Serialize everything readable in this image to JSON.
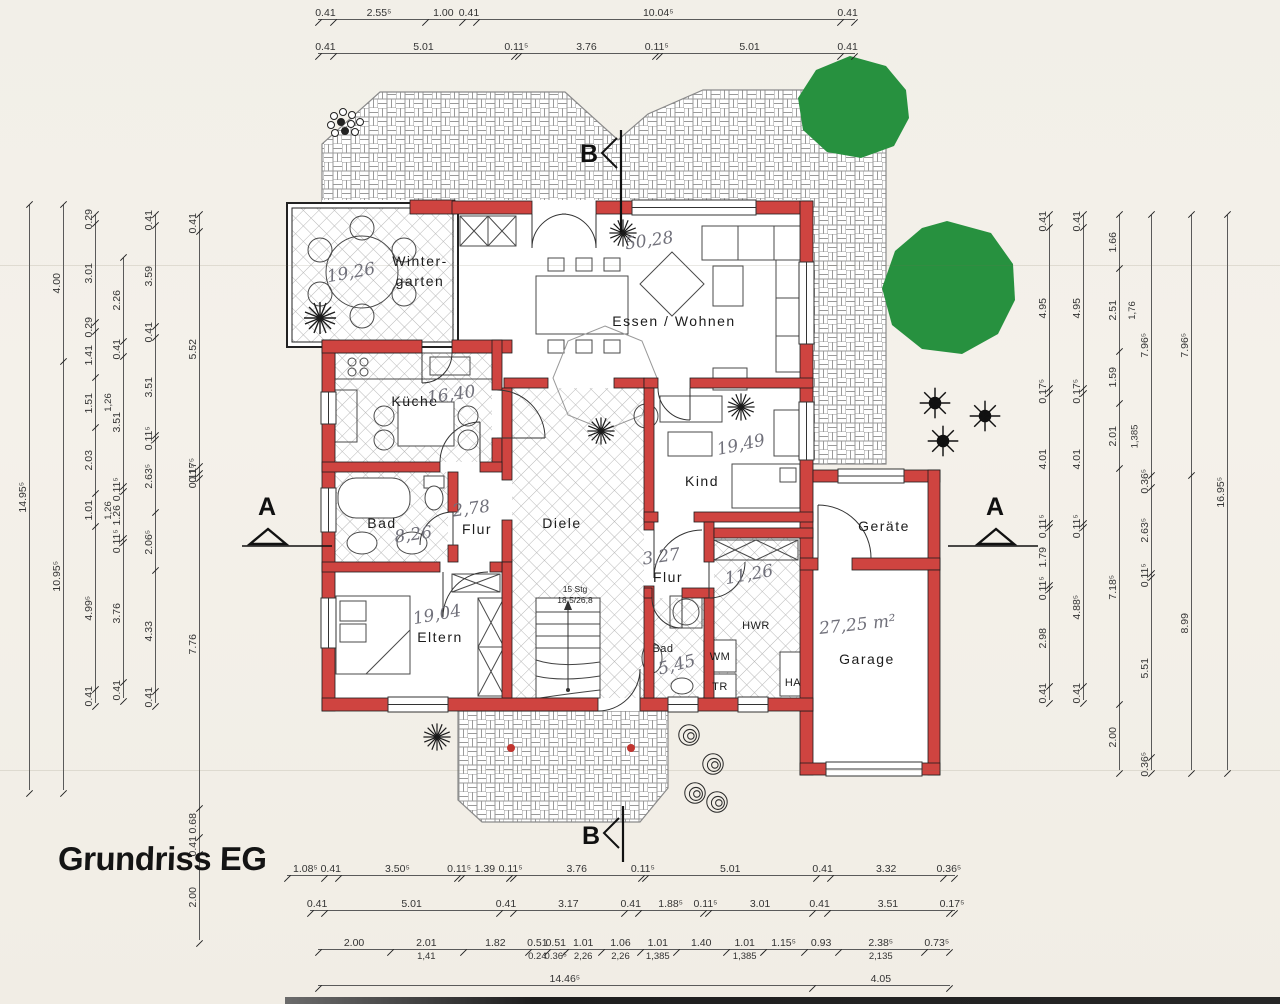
{
  "title": "Grundriss EG",
  "plan": {
    "rooms": {
      "wintergarten": {
        "line1": "Winter-",
        "line2": "garten",
        "area": "19,26"
      },
      "essen": {
        "name": "Essen / Wohnen",
        "area": "50,28"
      },
      "kueche": {
        "name": "Küche",
        "area": "16,40"
      },
      "kind": {
        "name": "Kind",
        "area": "19,49"
      },
      "bad1": {
        "name": "Bad",
        "area": "8,26"
      },
      "flur1": {
        "name": "Flur",
        "area": "2,78"
      },
      "diele": {
        "name": "Diele"
      },
      "flur2": {
        "name": "Flur",
        "area": "3,27"
      },
      "eltern": {
        "name": "Eltern",
        "area": "19,04"
      },
      "bad2": {
        "name": "Bad",
        "area": "5,45"
      },
      "hwr": {
        "name": "HWR",
        "area": "11,26"
      },
      "geraete": {
        "name": "Geräte"
      },
      "garage": {
        "name": "Garage",
        "area": "27,25 m²"
      }
    },
    "stairs": {
      "line1": "15 Stg",
      "line2": "18,5/26,8"
    },
    "appliances": {
      "wm": "WM",
      "tr": "TR",
      "ha": "HA"
    },
    "markers": {
      "a": "A",
      "b": "B"
    }
  },
  "dimensions": {
    "top": [
      {
        "values": [
          "0.41",
          "2.55⁵",
          "1.00",
          "0.41",
          "10.04⁵",
          "0.41"
        ]
      },
      {
        "values": [
          "0.41",
          "5.01",
          "0.11⁵",
          "3.76",
          "0.11⁵",
          "5.01",
          "0.41"
        ]
      }
    ],
    "bottom": [
      {
        "values": [
          "1.08⁵",
          "0.41",
          "3.50⁵",
          "0.11⁵",
          "1.39",
          "0.11⁵",
          "3.76",
          "0.11⁵",
          "5.01",
          "0.41",
          "3.32",
          "0.36⁵"
        ]
      },
      {
        "values": [
          "0.41",
          "5.01",
          "0.41",
          "3.17",
          "0.41",
          "1.88⁵",
          "0.11⁵",
          "3.01",
          "0.41",
          "3.51",
          "0.17⁵"
        ]
      },
      {
        "values": [
          "2.00",
          {
            "v": "2.01",
            "sub": "1,41"
          },
          "1.82",
          {
            "v": "0.51",
            "sub": "0.24"
          },
          {
            "v": "0.51",
            "sub": "0.36⁵"
          },
          {
            "v": "1.01",
            "sub": "2,26"
          },
          {
            "v": "1.06",
            "sub": "2,26"
          },
          {
            "v": "1.01",
            "sub": "1,385"
          },
          "1.40",
          {
            "v": "1.01",
            "sub": "1,385"
          },
          "1.15⁵",
          "0.93",
          {
            "v": "2.38⁵",
            "sub": "2,135"
          },
          "0.73⁵"
        ]
      },
      {
        "values": [
          "14.46⁵",
          "4.05"
        ]
      },
      {
        "values": [
          "11.92",
          "3.69⁵"
        ]
      }
    ],
    "left": [
      {
        "values": [
          "14.95⁵"
        ]
      },
      {
        "values": [
          "4.00",
          "10.95⁵"
        ]
      },
      {
        "values": [
          "0.29",
          "3.01",
          "0.29",
          "1.41",
          {
            "v": "1.51",
            "sub": "1,26"
          },
          "2.03",
          {
            "v": "1.01",
            "sub": "1,26"
          },
          "4.99⁵",
          "0.41"
        ]
      },
      {
        "values": [
          "2.26",
          "0.41",
          "3.51",
          "0.11⁵",
          "1.26",
          "0.11⁵",
          "3.76",
          "0.41"
        ]
      },
      {
        "values": [
          "0.41",
          "3.59",
          "0.41",
          "3.51",
          "0.11⁵",
          "2.63⁵",
          "2.06⁵",
          "4.33",
          "0.41"
        ]
      },
      {
        "values": [
          "0.41",
          "5.52",
          "0.17⁵",
          "0.11⁵",
          "7.76",
          "0.68",
          "0.41",
          "2.00"
        ]
      }
    ],
    "right": [
      {
        "values": [
          "0.41",
          "4.95",
          "0.17⁵",
          "4.01",
          "0.11⁵",
          "1.79",
          "0.11⁵",
          "2.98",
          "0.41"
        ]
      },
      {
        "values": [
          "0.41",
          "4.95",
          "0.17⁵",
          "4.01",
          "0.11⁵",
          "4.88⁵",
          "0.41"
        ]
      },
      {
        "values": [
          "1.66",
          {
            "v": "2.51",
            "sub": "1,76"
          },
          "1.59",
          {
            "v": "2.01",
            "sub": "1,385"
          },
          "7.18⁵",
          "2.00"
        ]
      },
      {
        "values": [
          "7.96⁵",
          "0.36⁵",
          "2.63⁵",
          "0.11⁵",
          "5.51",
          "0.36⁵"
        ]
      },
      {
        "values": [
          "7.96⁵",
          "8.99"
        ]
      },
      {
        "values": [
          "16.95⁵"
        ]
      }
    ]
  }
}
